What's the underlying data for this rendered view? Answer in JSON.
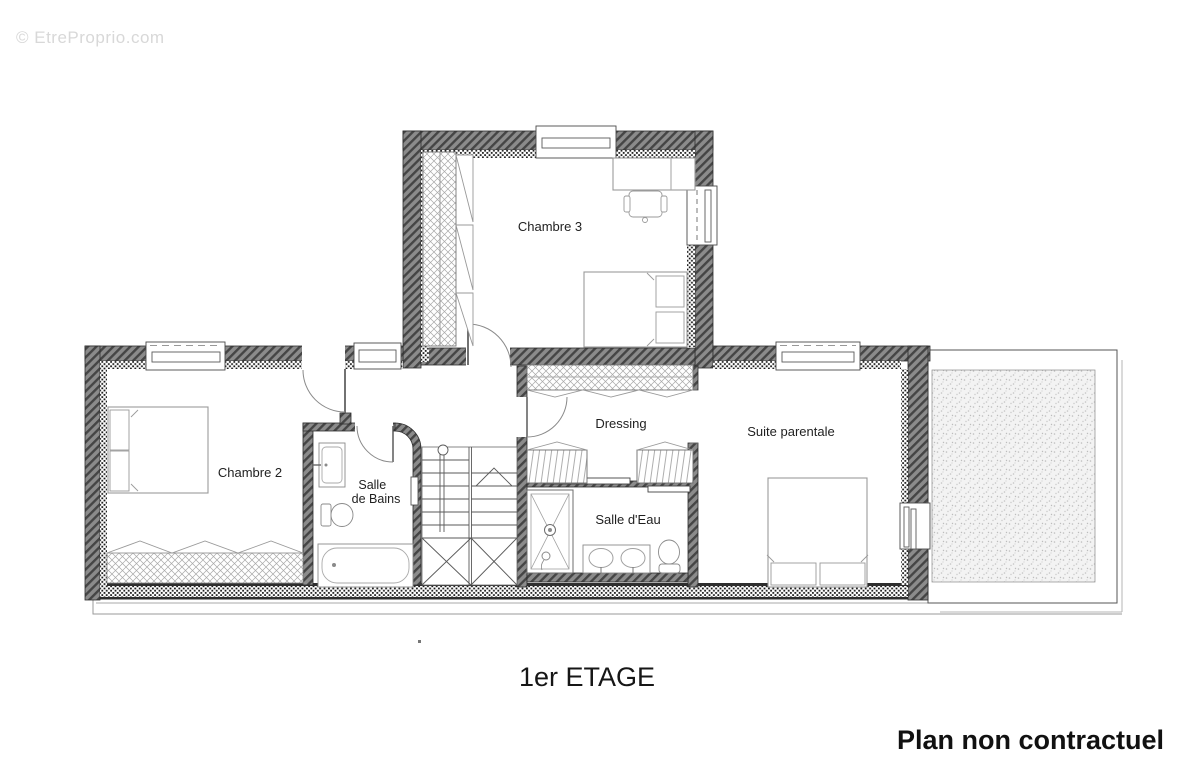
{
  "watermark": "© EtreProprio.com",
  "footer": {
    "floor_label": "1er ETAGE",
    "disclaimer": "Plan non contractuel"
  },
  "rooms": {
    "chambre3": "Chambre 3",
    "chambre2": "Chambre 2",
    "salle_de_bains_lines": {
      "l1": "Salle",
      "l2": "de Bains"
    },
    "dressing": "Dressing",
    "salle_deau": "Salle d'Eau",
    "suite_parentale": "Suite parentale"
  },
  "colors": {
    "wall_fill": "#8b8b8b",
    "wall_hatch": "#454545",
    "wall_outline": "#2c2c2c",
    "furniture_line": "#8a8a8a",
    "label_text": "#1f1f1f",
    "watermark_text": "#d8d8d8"
  }
}
